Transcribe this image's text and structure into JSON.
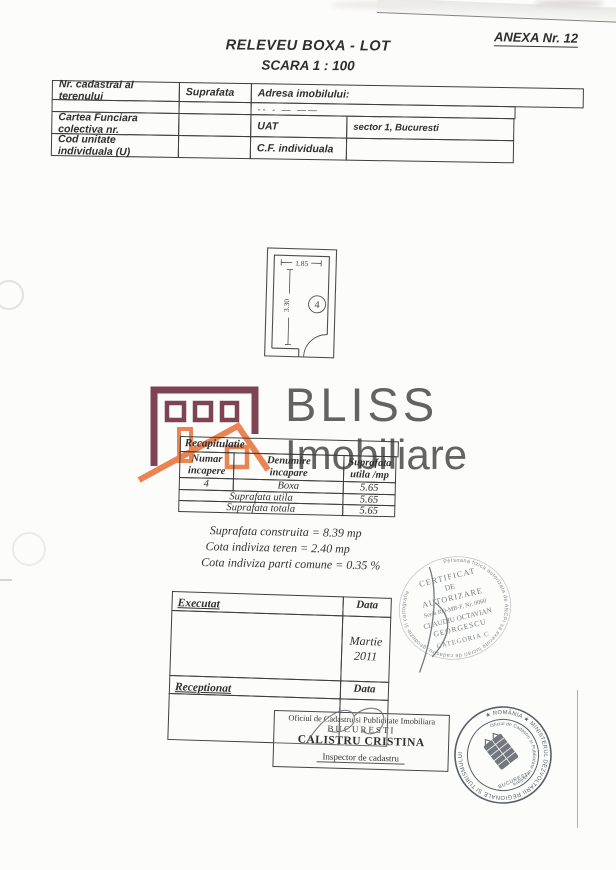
{
  "page": {
    "annex": "ANEXA Nr. 12",
    "title": "RELEVEU BOXA - LOT",
    "scale": "SCARA 1 : 100"
  },
  "header_table": {
    "c1": "Nr. cadastral al terenului",
    "c2": "Suprafata",
    "c3": "Adresa imobilului:",
    "address_redacted": "-- -        —     ——",
    "r3c1": "Cartea Funciara colectiva nr.",
    "r3c3": "UAT",
    "r3c4": "sector 1, Bucuresti",
    "r4c1": "Cod unitate individuala (U)",
    "r4c3": "C.F. individuala"
  },
  "floorplan": {
    "width_dim": "1.85",
    "height_dim": "3.30",
    "room_number": "4"
  },
  "logo": {
    "name_top": "BLISS",
    "name_bottom": "Imobiliare",
    "colors": {
      "maroon": "#6e2b3d",
      "orange": "#e8743c",
      "text_gray": "#4f4f4f"
    }
  },
  "recap_table": {
    "title": "Recapitulatie",
    "h1a": "Numar",
    "h1b": "incapere",
    "h2a": "Denumire",
    "h2b": "incapare",
    "h3a": "Suprafata",
    "h3b": "utila /mp",
    "row": {
      "nr": "4",
      "name": "Boxa",
      "area": "5.65"
    },
    "total1_label": "Suprafata utila",
    "total1_value": "5.65",
    "total2_label": "Suprafata totala",
    "total2_value": "5.65"
  },
  "summary": {
    "line1": "Suprafata construita = 8.39 mp",
    "line2": "Cota indiviza teren = 2.40 mp",
    "line3": "Cota indiviza parti comune = 0.35 %"
  },
  "exec_table": {
    "executat": "Executat",
    "data_label1": "Data",
    "date_value": "Martie 2011",
    "receptionat": "Receptionat",
    "data_label2": "Data"
  },
  "office_box": {
    "line1": "Oficiul de Cadastru si Publicitate Imobiliara",
    "line2": "BUCURESTI",
    "name": "CALISTRU CRISTINA",
    "role": "Inspector de cadastru"
  },
  "cert_stamp": {
    "ring_text": "Persoana fizica autorizata de ANCPI sa execute lucrari de cadastru, geodezie si cartografie",
    "l1": "CERTIFICAT",
    "l2": "DE",
    "l3": "AUTORIZARE",
    "l4": "Seria RO-MB-F, Nr. 0060",
    "l5": "CLAUDIU OCTAVIAN",
    "l6": "GEORGESCU",
    "l7": "CATEGORIA C",
    "ink_color": "#6b7076"
  },
  "round_stamp": {
    "outer_text": "★ ROMÂNIA ★ MINISTERUL DEZVOLTARII REGIONALE SI TURISMULUI",
    "inner_text": "Oficiul de Cadastru si Publicitate Imobiliara",
    "city": "BUCURESTI",
    "ink_color": "#4c525c"
  }
}
